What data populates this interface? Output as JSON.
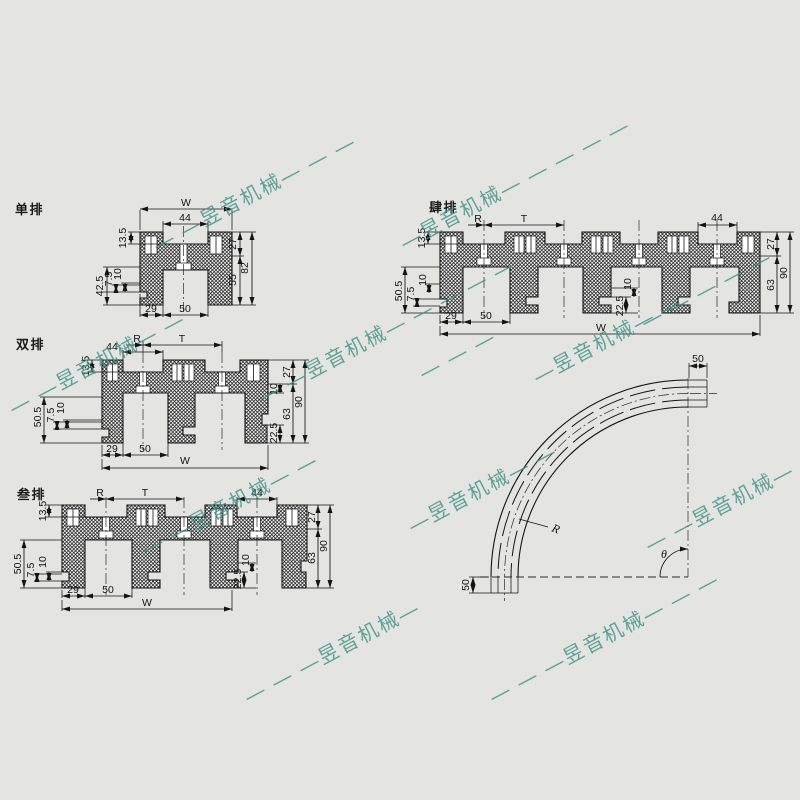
{
  "sheet": {
    "background": "#e4e4e3",
    "line_color": "#141414",
    "watermark_color": "#3E9180"
  },
  "watermark": {
    "text": "昱音机械",
    "segments": [
      "— —昱音机械— — —",
      "—昱音机械— — — — —",
      "— —昱音机械— —",
      "— —昱音机械— — — — —",
      "— —昱音机械— —",
      "— — —昱音机械—",
      "— — —昱音机械— — —",
      "— —昱音机械— —",
      "— — — — —",
      "—昱音机械— —",
      "—昱音机械— —",
      "— — —"
    ]
  },
  "single": {
    "label": "单排",
    "W": "W",
    "w44": "44",
    "h135": "13.5",
    "h27": "27",
    "h55": "55",
    "h82": "82",
    "h425": "42.5",
    "h75": "7.5",
    "h10": "10",
    "w29": "29",
    "w50": "50"
  },
  "double": {
    "label": "双排",
    "R": "R",
    "T": "T",
    "w44": "44",
    "h135": "13.5",
    "h10r": "10",
    "h27": "27",
    "h63": "63",
    "h225": "22.5",
    "h90": "90",
    "h505": "50.5",
    "h75": "7.5",
    "h10l": "10",
    "w29": "29",
    "w50": "50",
    "W": "W"
  },
  "triple": {
    "label": "叁排",
    "R": "R",
    "T": "T",
    "w44": "44",
    "h135": "13.5",
    "h27": "27",
    "h63": "63",
    "h90": "90",
    "h505": "50.5",
    "h75": "7.5",
    "h10l": "10",
    "h225": "22.5",
    "h10m": "10",
    "w29": "29",
    "w50": "50",
    "W": "W"
  },
  "quad": {
    "label": "肆排",
    "R": "R",
    "T": "T",
    "w44": "44",
    "h135": "13.5",
    "h27": "27",
    "h63": "63",
    "h90": "90",
    "h505": "50.5",
    "h75": "7.5",
    "h10l": "10",
    "h225": "22.5",
    "h10m": "10",
    "w29": "29",
    "w50": "50",
    "W": "W"
  },
  "curve": {
    "top50": "50",
    "side50": "50",
    "R": "R",
    "angle": "θ"
  }
}
